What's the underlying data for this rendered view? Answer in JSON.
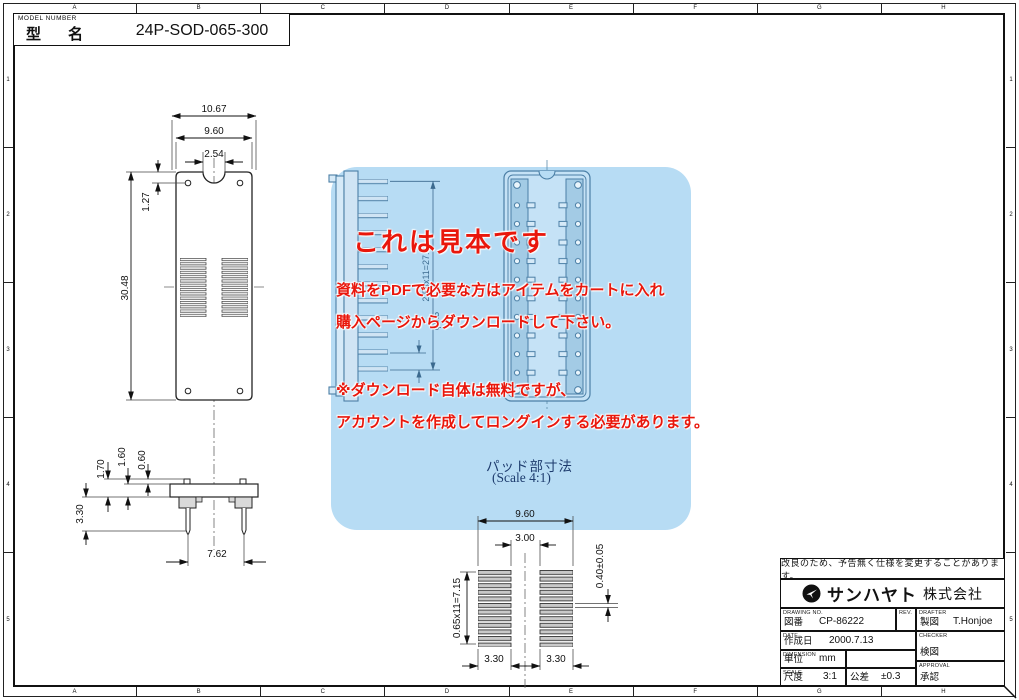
{
  "model_box": {
    "caption": "MODEL NUMBER",
    "label": "型　名",
    "value": "24P-SOD-065-300"
  },
  "grid": {
    "cols": [
      "A",
      "B",
      "C",
      "D",
      "E",
      "F",
      "G",
      "H"
    ],
    "rows": [
      "1",
      "2",
      "3",
      "4",
      "5"
    ]
  },
  "watermark": {
    "heading": "これは見本です",
    "line1": "資料をPDFで必要な方はアイテムをカートに入れ",
    "line2": "購入ページからダウンロードして下さい。",
    "line3": "※ダウンロード自体は無料ですが、",
    "line4": "アカウントを作成してロングインする必要があります。",
    "pad_title": "パッド部寸法",
    "pad_scale": "(Scale 4:1)"
  },
  "dims": {
    "top_view": {
      "overall_width": "10.67",
      "body_width": "9.60",
      "notch_width": "2.54",
      "hole_offset": "1.27",
      "body_length": "30.48"
    },
    "side_view": {
      "h_total": "1.70",
      "h_body": "1.60",
      "h_tab": "0.60",
      "pin_length": "3.30",
      "pin_span": "7.62"
    },
    "socket_view": {
      "pitch_total": "2.54x11=27.94",
      "pin_dia": "φ0.5"
    },
    "pad_detail": {
      "overall": "9.60",
      "gap": "3.00",
      "pitch_total": "0.65x11=7.15",
      "pad_height": "0.40±0.05",
      "pad_width_left": "3.30",
      "pad_width_right": "3.30"
    }
  },
  "title_block": {
    "note": "改良のため、予告無く仕様を変更することがあります。",
    "company": "サンハヤト",
    "company_suffix": "株式会社",
    "drawing_no_caption": "DRAWING NO.",
    "drawing_no_label": "図番",
    "drawing_no": "CP-86222",
    "rev_caption": "REV.",
    "drafter_caption": "DRAFTER",
    "drafter_label": "製図",
    "drafter": "T.Honjoe",
    "date_caption": "DATE",
    "date_label": "作成日",
    "date": "2000.7.13",
    "checker_caption": "CHECKER",
    "checker_label": "検図",
    "dimension_caption": "DIMENSION",
    "unit_label": "単位",
    "unit": "mm",
    "scale_caption": "SCALE",
    "scale_label": "尺度",
    "scale": "3:1",
    "tolerance_label": "公差",
    "tolerance": "±0.3",
    "approval_caption": "APPROVAL",
    "approval_label": "承認"
  },
  "colors": {
    "watermark_box": "#b7dcf4",
    "watermark_text": "#e9170c",
    "pad_caption_text": "#1e3c6e",
    "blue_line": "#4b7fa6",
    "line": "#111111"
  }
}
